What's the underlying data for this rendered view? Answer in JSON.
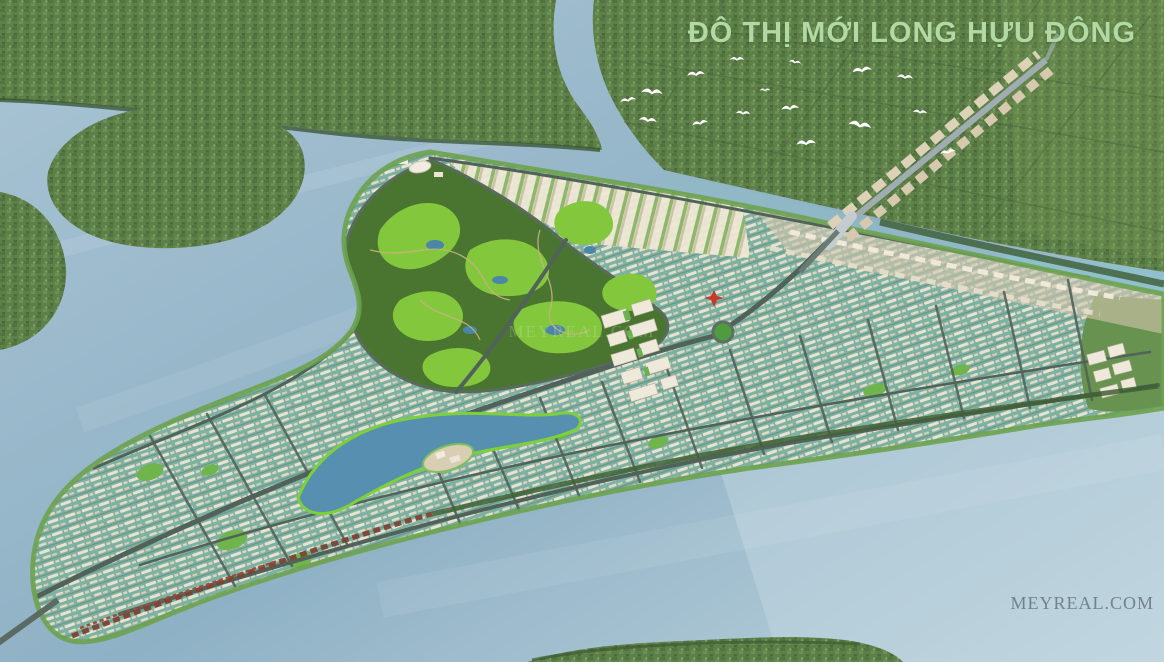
{
  "title": {
    "text": "ĐÔ THỊ MỚI LONG HỰU ĐÔNG",
    "color": "#b2d9a4"
  },
  "watermarks": {
    "center": {
      "text": "MEYREAL.COM"
    },
    "bottom_right": {
      "text": "MEYREAL.COM"
    }
  },
  "scene": {
    "palette": {
      "river_water": "#a9c4d4",
      "deep_water": "#8fb1c5",
      "shallow_water": "#bdd3dd",
      "farmland_green": "#5e8048",
      "golf_base": "#4a7531",
      "golf_fairway": "#83c73d",
      "residential_teal": "#7db2a2",
      "building_white": "#efe9db",
      "road_gray": "#51625a",
      "corridor_tan": "#ddd1b8",
      "mangrove_red": "#7c4336",
      "title_green": "#b2d9a4"
    },
    "birds": {
      "count": 16,
      "positions": [
        [
          628,
          100,
          0.9,
          -10
        ],
        [
          652,
          92,
          1.2,
          5
        ],
        [
          696,
          74,
          1.0,
          -5
        ],
        [
          737,
          59,
          0.8,
          0
        ],
        [
          795,
          62,
          0.7,
          10
        ],
        [
          862,
          70,
          1.1,
          -8
        ],
        [
          905,
          77,
          0.9,
          5
        ],
        [
          648,
          120,
          1.0,
          8
        ],
        [
          700,
          123,
          0.9,
          -12
        ],
        [
          743,
          113,
          0.8,
          4
        ],
        [
          790,
          108,
          1.0,
          -6
        ],
        [
          860,
          125,
          1.3,
          10
        ],
        [
          806,
          143,
          1.1,
          -4
        ],
        [
          920,
          112,
          0.8,
          6
        ],
        [
          948,
          152,
          0.9,
          -10
        ],
        [
          765,
          90,
          0.6,
          0
        ]
      ]
    }
  }
}
